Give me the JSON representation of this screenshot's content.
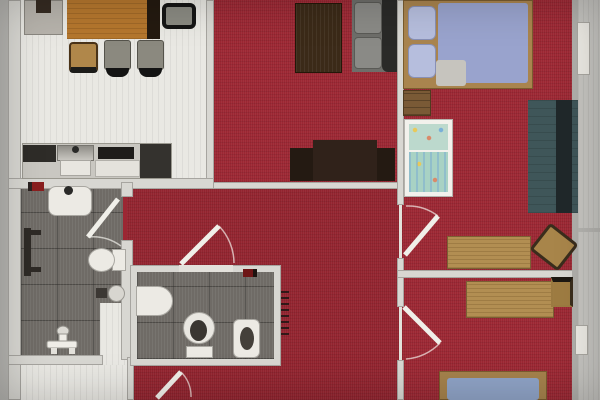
{
  "document": {
    "title": "Apartment floor plan – top-down rendered photo",
    "type": "architectural floor plan, no text labels visible"
  },
  "palette": {
    "carpet_red": "#9c2733",
    "floor_light": "#e9e8e3",
    "tile_gray": "#6f6b66",
    "wall_light": "#d8d7d2",
    "balcony_gray": "#c6c5c1",
    "wood_table": "#b5772e",
    "wood_desk": "#b28e52",
    "coffee_table_dark": "#3b2a18",
    "sofa_gray": "#6e6e6a",
    "sofa_teal": "#3f5659",
    "mattress_blue": "#99a3cd",
    "crib_teal": "#a8d2c4"
  },
  "rooms": [
    {
      "name": "Dining room / kitchen",
      "floor": "light laminate",
      "furniture": [
        "sideboard",
        "dining table",
        "black chair",
        "wooden chair",
        "two upholstered chairs",
        "kitchen counter with sink, cooktop and dark cabinets"
      ]
    },
    {
      "name": "Living room",
      "floor": "red carpet",
      "furniture": [
        "dark coffee table",
        "gray sofa",
        "TV sideboard"
      ]
    },
    {
      "name": "Bedroom top-right",
      "floor": "red carpet",
      "furniture": [
        "double bed with blue bedding",
        "wall shelf",
        "baby crib with patterned bedding",
        "teal sofa bed",
        "desk",
        "swivel chair"
      ]
    },
    {
      "name": "Bedroom bottom-right",
      "floor": "red carpet",
      "furniture": [
        "desk",
        "chair",
        "single bed with blue mattress"
      ]
    },
    {
      "name": "Bathroom left",
      "floor": "dark gray tiles",
      "furniture": [
        "washbasin",
        "towel radiator",
        "toilet",
        "round stool",
        "small box",
        "shower fitting"
      ]
    },
    {
      "name": "WC center",
      "floor": "dark gray tiles",
      "furniture": [
        "washbasin",
        "toilet",
        "bidet",
        "small red accessory",
        "radiator ticks on outer wall"
      ]
    },
    {
      "name": "Hallway",
      "floor": "red carpet",
      "furniture": []
    },
    {
      "name": "Balcony strip right edge",
      "floor": "gray decking",
      "furniture": [
        "window top",
        "window bottom"
      ]
    }
  ],
  "doors": [
    {
      "name": "bathroom-left door",
      "location": "right wall of left bathroom, swings inward"
    },
    {
      "name": "wc door",
      "location": "top wall of center WC, swings into hallway"
    },
    {
      "name": "bedroom-top-right door",
      "location": "hallway wall, swings east"
    },
    {
      "name": "bedroom-bottom-right door",
      "location": "hallway wall, swings east"
    },
    {
      "name": "bottom-left door",
      "location": "bottom edge near left bathroom"
    }
  ],
  "notes": "Photo of a rendered plan; red carpet in living areas, tiles in wet rooms, light wood furniture."
}
